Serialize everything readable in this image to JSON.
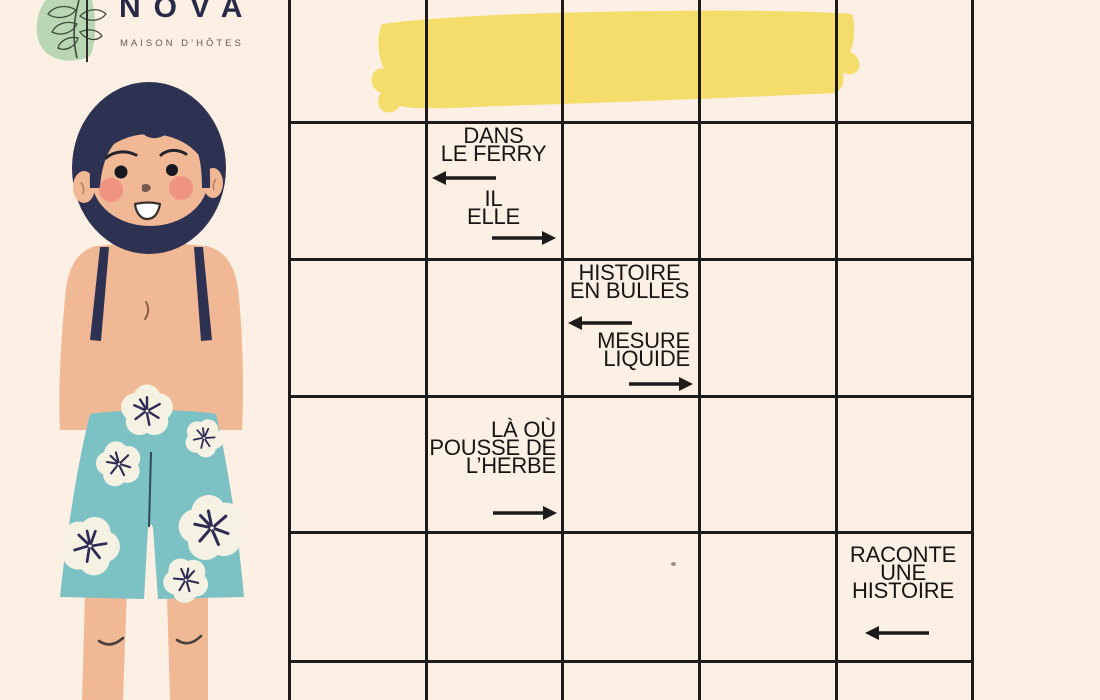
{
  "logo": {
    "title": "NOVA",
    "subtitle": "MAISON D’HÔTES"
  },
  "puzzle": {
    "type": "mots-fléchés (arrow crossword) worksheet",
    "grid": {
      "columns": 5,
      "rows": 6,
      "line_color": "#1d1b19"
    },
    "clues": {
      "ferry": {
        "l1": "DANS",
        "l2": "LE FERRY",
        "arrow1": "left",
        "l3": "IL",
        "l4": "ELLE",
        "arrow2": "right"
      },
      "bulles": {
        "l1": "HISTOIRE",
        "l2": "EN BULLES",
        "arrow1": "left",
        "l3": "MESURE",
        "l4": "LIQUIDE",
        "arrow2": "right"
      },
      "herbe": {
        "l1": "LÀ OÙ",
        "l2": "POUSSE DE",
        "l3": "L’HERBE",
        "arrow1": "right"
      },
      "raconte": {
        "l1": "RACONTE",
        "l2": "UNE",
        "l3": "HISTOIRE",
        "arrow1": "left"
      }
    }
  },
  "colors": {
    "background": "#fcefe4",
    "grid_line": "#1d1b19",
    "clue_text": "#171513",
    "highlighter": "#f6ea6c",
    "logo_navy": "#272b46",
    "logo_subtitle_gray": "#645c52",
    "branch_green": "#b8d7b2",
    "hair_navy": "#2d3152",
    "skin": "#f0b894",
    "blush": "#f0907f",
    "shorts_teal": "#7cc2c4",
    "flower_cream": "#f6f2e3"
  }
}
